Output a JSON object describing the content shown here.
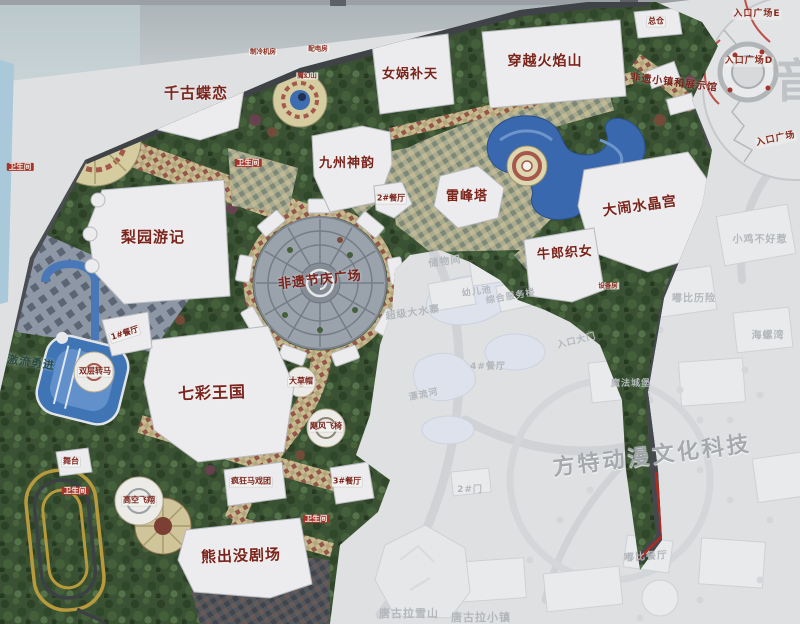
{
  "colors": {
    "boundary_red": "#b5291f",
    "attraction_text_red": "#7b241c",
    "restroom_badge_red": "#a5352a",
    "water_blue": "#3a68ae",
    "foliage_green": "#3a5233",
    "faded_text_grey": "#b3b7bb"
  },
  "labels": {
    "attractions": [
      {
        "text": "千古蝶恋",
        "x": 196,
        "y": 93,
        "fs": 15,
        "rot": 0
      },
      {
        "text": "女娲补天",
        "x": 410,
        "y": 75,
        "fs": 13,
        "rot": 0
      },
      {
        "text": "穿越火焰山",
        "x": 545,
        "y": 62,
        "fs": 14,
        "rot": 0
      },
      {
        "text": "九州神韵",
        "x": 347,
        "y": 164,
        "fs": 13,
        "rot": 0
      },
      {
        "text": "雷峰塔",
        "x": 467,
        "y": 197,
        "fs": 13,
        "rot": 0
      },
      {
        "text": "大闹水晶宫",
        "x": 640,
        "y": 207,
        "fs": 14,
        "rot": -8
      },
      {
        "text": "牛郎织女",
        "x": 565,
        "y": 254,
        "fs": 13,
        "rot": -4
      },
      {
        "text": "梨园游记",
        "x": 153,
        "y": 237,
        "fs": 15,
        "rot": 0
      },
      {
        "text": "非遗节庆广场",
        "x": 320,
        "y": 281,
        "fs": 13,
        "rot": -6
      },
      {
        "text": "七彩王国",
        "x": 212,
        "y": 393,
        "fs": 16,
        "rot": -2
      },
      {
        "text": "熊出没剧场",
        "x": 241,
        "y": 556,
        "fs": 15,
        "rot": -2
      },
      {
        "text": "非遗小镇和展示馆",
        "x": 674,
        "y": 83,
        "fs": 10,
        "rot": 7
      },
      {
        "text": "激流勇进",
        "x": 31,
        "y": 363,
        "fs": 11,
        "rot": 8,
        "color": "#2a4a40"
      }
    ],
    "facilities": [
      {
        "text": "总仓",
        "x": 656,
        "y": 22,
        "fs": 8
      },
      {
        "text": "2#餐厅",
        "x": 391,
        "y": 199,
        "fs": 8
      },
      {
        "text": "1#餐厅",
        "x": 125,
        "y": 334,
        "fs": 8,
        "rot": -18
      },
      {
        "text": "3#餐厅",
        "x": 347,
        "y": 482,
        "fs": 8
      },
      {
        "text": "大草帽",
        "x": 301,
        "y": 382,
        "fs": 8
      },
      {
        "text": "飓风飞椅",
        "x": 326,
        "y": 427,
        "fs": 8
      },
      {
        "text": "双层转马",
        "x": 95,
        "y": 372,
        "fs": 8
      },
      {
        "text": "舞台",
        "x": 71,
        "y": 462,
        "fs": 8
      },
      {
        "text": "高空飞翔",
        "x": 139,
        "y": 501,
        "fs": 8
      },
      {
        "text": "疯狂马戏团",
        "x": 251,
        "y": 482,
        "fs": 8
      }
    ],
    "tiny_labels": [
      {
        "text": "制冷机房",
        "x": 263,
        "y": 52,
        "fs": 6.5
      },
      {
        "text": "配电房",
        "x": 318,
        "y": 49,
        "fs": 6.5
      },
      {
        "text": "魔幻山",
        "x": 307,
        "y": 76,
        "fs": 6.5
      },
      {
        "text": "设备房",
        "x": 608,
        "y": 286,
        "fs": 6.5
      }
    ],
    "restrooms": [
      {
        "text": "卫生间",
        "x": 20,
        "y": 167,
        "fs": 7.5
      },
      {
        "text": "卫生间",
        "x": 248,
        "y": 163,
        "fs": 7.5
      },
      {
        "text": "卫生间",
        "x": 75,
        "y": 491,
        "fs": 7.5
      },
      {
        "text": "卫生间",
        "x": 316,
        "y": 519,
        "fs": 7.5
      }
    ],
    "entrances": [
      {
        "text": "入口广场E",
        "x": 757,
        "y": 15,
        "fs": 9
      },
      {
        "text": "入口广场D",
        "x": 749,
        "y": 62,
        "fs": 9
      },
      {
        "text": "入口广场",
        "x": 776,
        "y": 140,
        "fs": 9,
        "rot": -12
      }
    ],
    "faded_labels": [
      {
        "text": "储物间",
        "x": 445,
        "y": 262,
        "fs": 10,
        "rot": -8
      },
      {
        "text": "幼儿池",
        "x": 477,
        "y": 293,
        "fs": 9,
        "rot": -8
      },
      {
        "text": "超级大水寨",
        "x": 413,
        "y": 313,
        "fs": 10,
        "rot": -8
      },
      {
        "text": "4#餐厅",
        "x": 488,
        "y": 368,
        "fs": 9,
        "rot": 0
      },
      {
        "text": "漂流河",
        "x": 424,
        "y": 396,
        "fs": 9,
        "rot": -12
      },
      {
        "text": "综合服务楼",
        "x": 511,
        "y": 298,
        "fs": 9,
        "rot": -10
      },
      {
        "text": "入口大门",
        "x": 577,
        "y": 342,
        "fs": 9,
        "rot": -14
      },
      {
        "text": "2#门",
        "x": 470,
        "y": 491,
        "fs": 9,
        "rot": 0
      },
      {
        "text": "小鸡不好惹",
        "x": 760,
        "y": 240,
        "fs": 10,
        "rot": 0
      },
      {
        "text": "嘟比历险",
        "x": 694,
        "y": 299,
        "fs": 10,
        "rot": 0
      },
      {
        "text": "海螺湾",
        "x": 768,
        "y": 336,
        "fs": 10,
        "rot": 0
      },
      {
        "text": "魔法城堡",
        "x": 631,
        "y": 385,
        "fs": 9,
        "rot": 0
      },
      {
        "text": "嘟比餐厅",
        "x": 646,
        "y": 557,
        "fs": 10,
        "rot": -4
      },
      {
        "text": "唐古拉雪山",
        "x": 409,
        "y": 614,
        "fs": 11,
        "rot": 0
      },
      {
        "text": "唐古拉小镇",
        "x": 481,
        "y": 618,
        "fs": 11,
        "rot": 0
      }
    ],
    "watermark": {
      "text": "方特动漫文化科技",
      "x": 712,
      "y": 452,
      "fs": 22,
      "rot": -7
    },
    "corner_char": {
      "text": "音",
      "x": 797,
      "y": 74,
      "fs": 46
    }
  }
}
